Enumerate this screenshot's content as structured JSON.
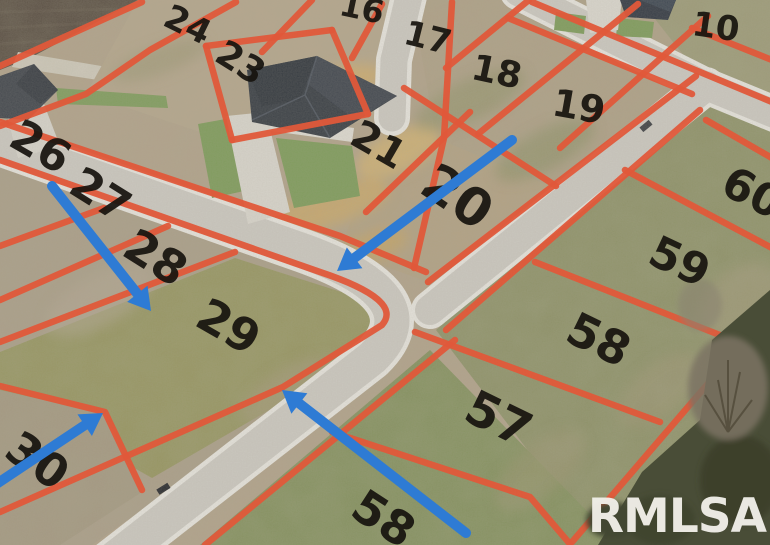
{
  "scene": {
    "type": "aerial-drone-photo",
    "subject": "Residential subdivision with vacant lots outlined in orange for sale",
    "watermark": "RMLSA"
  },
  "colors": {
    "lot_line": "#e0583a",
    "arrow": "#2e7bd4",
    "watermark": "#f1efe9",
    "label": "#17140f",
    "road": "#ccc9c1",
    "dirt": "#b2a28a",
    "grass_lot": "#8d9166",
    "roof": "#343a41"
  },
  "lot_labels": [
    {
      "n": "24",
      "x": 188,
      "y": 24,
      "rot": 26,
      "size": 34
    },
    {
      "n": "16",
      "x": 362,
      "y": 8,
      "rot": 12,
      "size": 32
    },
    {
      "n": "23",
      "x": 241,
      "y": 62,
      "rot": 32,
      "size": 36
    },
    {
      "n": "17",
      "x": 428,
      "y": 37,
      "rot": 14,
      "size": 34
    },
    {
      "n": "18",
      "x": 497,
      "y": 71,
      "rot": 12,
      "size": 36
    },
    {
      "n": "19",
      "x": 579,
      "y": 106,
      "rot": 10,
      "size": 38
    },
    {
      "n": "10",
      "x": 716,
      "y": 26,
      "rot": 8,
      "size": 34
    },
    {
      "n": "21",
      "x": 379,
      "y": 144,
      "rot": 30,
      "size": 40
    },
    {
      "n": "20",
      "x": 458,
      "y": 196,
      "rot": 34,
      "size": 52
    },
    {
      "n": "26",
      "x": 41,
      "y": 146,
      "rot": 30,
      "size": 44
    },
    {
      "n": "27",
      "x": 101,
      "y": 194,
      "rot": 32,
      "size": 44
    },
    {
      "n": "28",
      "x": 156,
      "y": 257,
      "rot": 32,
      "size": 46
    },
    {
      "n": "29",
      "x": 229,
      "y": 326,
      "rot": 30,
      "size": 46
    },
    {
      "n": "30",
      "x": 38,
      "y": 460,
      "rot": 35,
      "size": 46
    },
    {
      "n": "60",
      "x": 753,
      "y": 192,
      "rot": 27,
      "size": 44
    },
    {
      "n": "59",
      "x": 680,
      "y": 261,
      "rot": 25,
      "size": 44
    },
    {
      "n": "58",
      "x": 599,
      "y": 339,
      "rot": 26,
      "size": 46
    },
    {
      "n": "57",
      "x": 499,
      "y": 418,
      "rot": 26,
      "size": 48
    },
    {
      "n": "58",
      "x": 384,
      "y": 518,
      "rot": 33,
      "size": 46
    }
  ],
  "arrows": [
    {
      "x1": 52,
      "y1": 186,
      "x2": 151,
      "y2": 311
    },
    {
      "x1": 512,
      "y1": 140,
      "x2": 337,
      "y2": 271
    },
    {
      "x1": -8,
      "y1": 487,
      "x2": 103,
      "y2": 413
    },
    {
      "x1": 466,
      "y1": 533,
      "x2": 282,
      "y2": 390
    }
  ]
}
